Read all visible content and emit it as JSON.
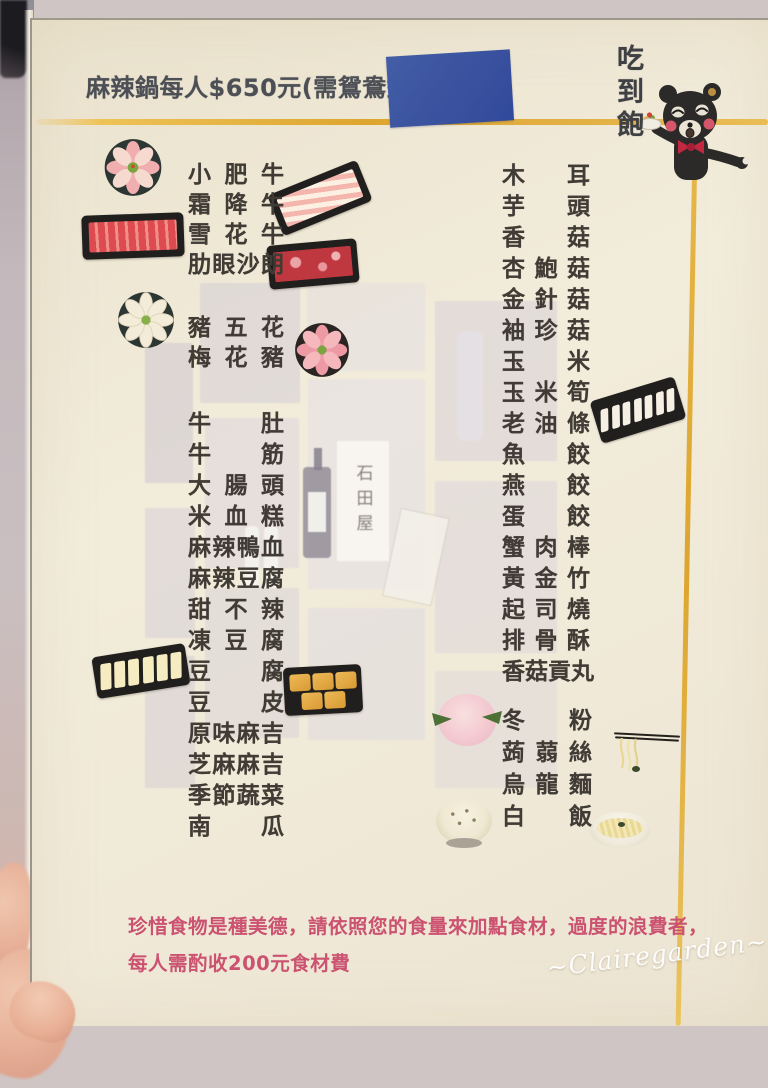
{
  "header": {
    "title": "麻辣鍋每人$650元(需鴛鴦鍋+",
    "eat_all_you_can": "吃到飽"
  },
  "menu": {
    "left_group_beef": [
      "小肥牛",
      "霜降牛",
      "雪花牛",
      "肋眼沙朗"
    ],
    "left_group_pork": [
      "豬五花",
      "梅花豬"
    ],
    "left_group_main": [
      "牛肚",
      "牛筋",
      "大腸頭",
      "米血糕",
      "麻辣鴨血",
      "麻辣豆腐",
      "甜不辣",
      "凍豆腐",
      "豆腐",
      "豆皮",
      "原味麻吉",
      "芝麻麻吉",
      "季節蔬菜",
      "南瓜"
    ],
    "right_group_main": [
      "木耳",
      "芋頭",
      "香菇",
      "杏鮑菇",
      "金針菇",
      "袖珍菇",
      "玉米",
      "玉米筍",
      "老油條",
      "魚餃",
      "燕餃",
      "蛋餃",
      "蟹肉棒",
      "黃金竹",
      "起司燒",
      "排骨酥",
      "香菇貢丸"
    ],
    "right_group_staples": [
      "冬粉",
      "蒟蒻絲",
      "烏龍麵",
      "白飯"
    ]
  },
  "background": {
    "shelf_label": "石田屋"
  },
  "footer": {
    "note_line1": "珍惜食物是種美德，請依照您的食量來加點食材，過度的浪費者，",
    "note_line2": "每人需酌收200元食材費"
  },
  "watermark": "~Clairegarden~",
  "colors": {
    "gold_line": "#dfa82f",
    "note_text": "#cb5270",
    "sticker_blue": "#3a55a3",
    "card_cream": "#efe8d6"
  }
}
